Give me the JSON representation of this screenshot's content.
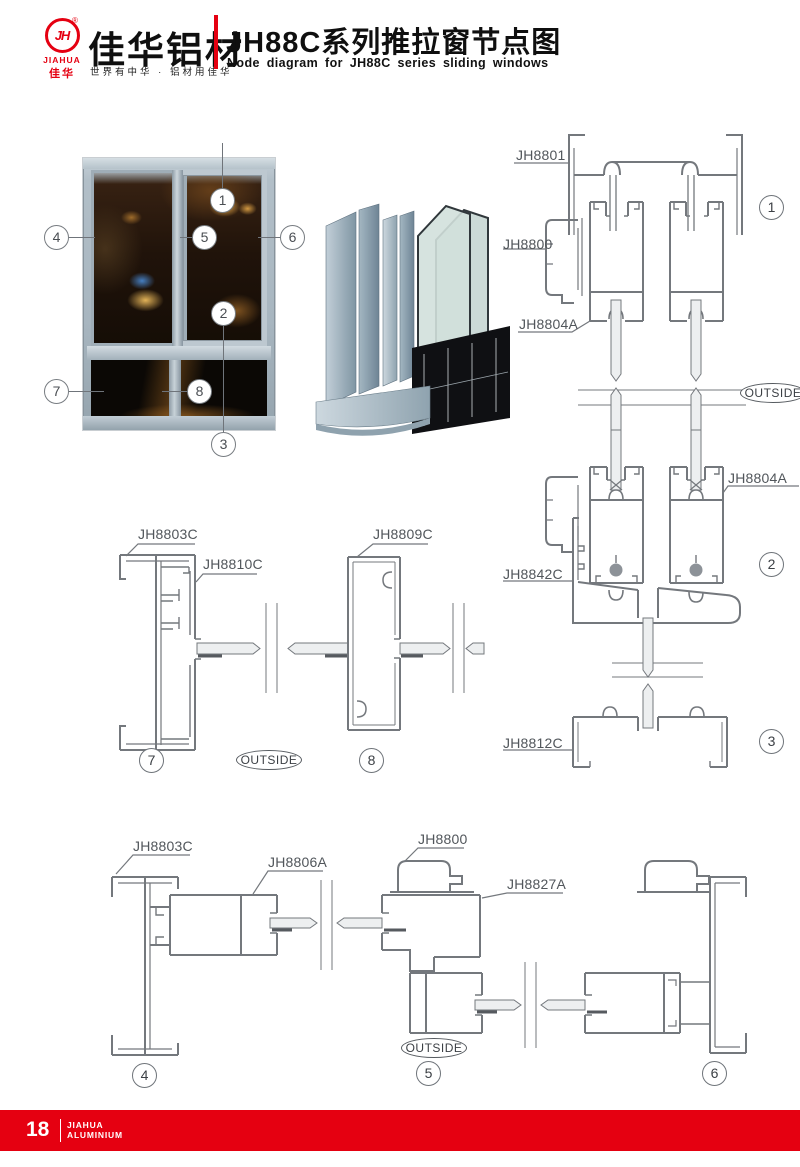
{
  "header": {
    "logo_monogram": "JH",
    "logo_reg": "®",
    "logo_name_en": "JIAHUA",
    "logo_name_cn": "佳华",
    "brand_cn": "佳华铝材",
    "tagline": "世界有中华 · 铝材用佳华",
    "title_cn": "JH88C系列推拉窗节点图",
    "title_en": "Node diagram for JH88C series sliding windows"
  },
  "colors": {
    "accent_red": "#e50011",
    "line_gray": "#74787d",
    "label_gray": "#51565b",
    "glass_fill": "#edeff0",
    "frame_blue_gray": "#b2bfc8"
  },
  "photo": {
    "callouts": {
      "c1": "1",
      "c2": "2",
      "c3": "3",
      "c4": "4",
      "c5": "5",
      "c6": "6",
      "c7": "7",
      "c8": "8"
    }
  },
  "diagrams": {
    "outside": "OUTSIDE",
    "d1": {
      "num": "1",
      "jh8801": "JH8801",
      "jh8800": "JH8800",
      "jh8804a": "JH8804A"
    },
    "d2": {
      "num": "2",
      "jh8804a": "JH8804A",
      "jh8842c": "JH8842C"
    },
    "d3": {
      "num": "3",
      "jh8812c": "JH8812C"
    },
    "d4": {
      "num": "4",
      "jh8803c": "JH8803C",
      "jh8806a": "JH8806A"
    },
    "d5": {
      "num": "5",
      "jh8800": "JH8800",
      "jh8827a": "JH8827A"
    },
    "d6": {
      "num": "6"
    },
    "d7": {
      "num": "7",
      "jh8803c": "JH8803C",
      "jh8810c": "JH8810C"
    },
    "d8": {
      "num": "8",
      "jh8809c": "JH8809C"
    }
  },
  "footer": {
    "page_number": "18",
    "brand_line1": "JIAHUA",
    "brand_line2": "ALUMINIUM"
  }
}
